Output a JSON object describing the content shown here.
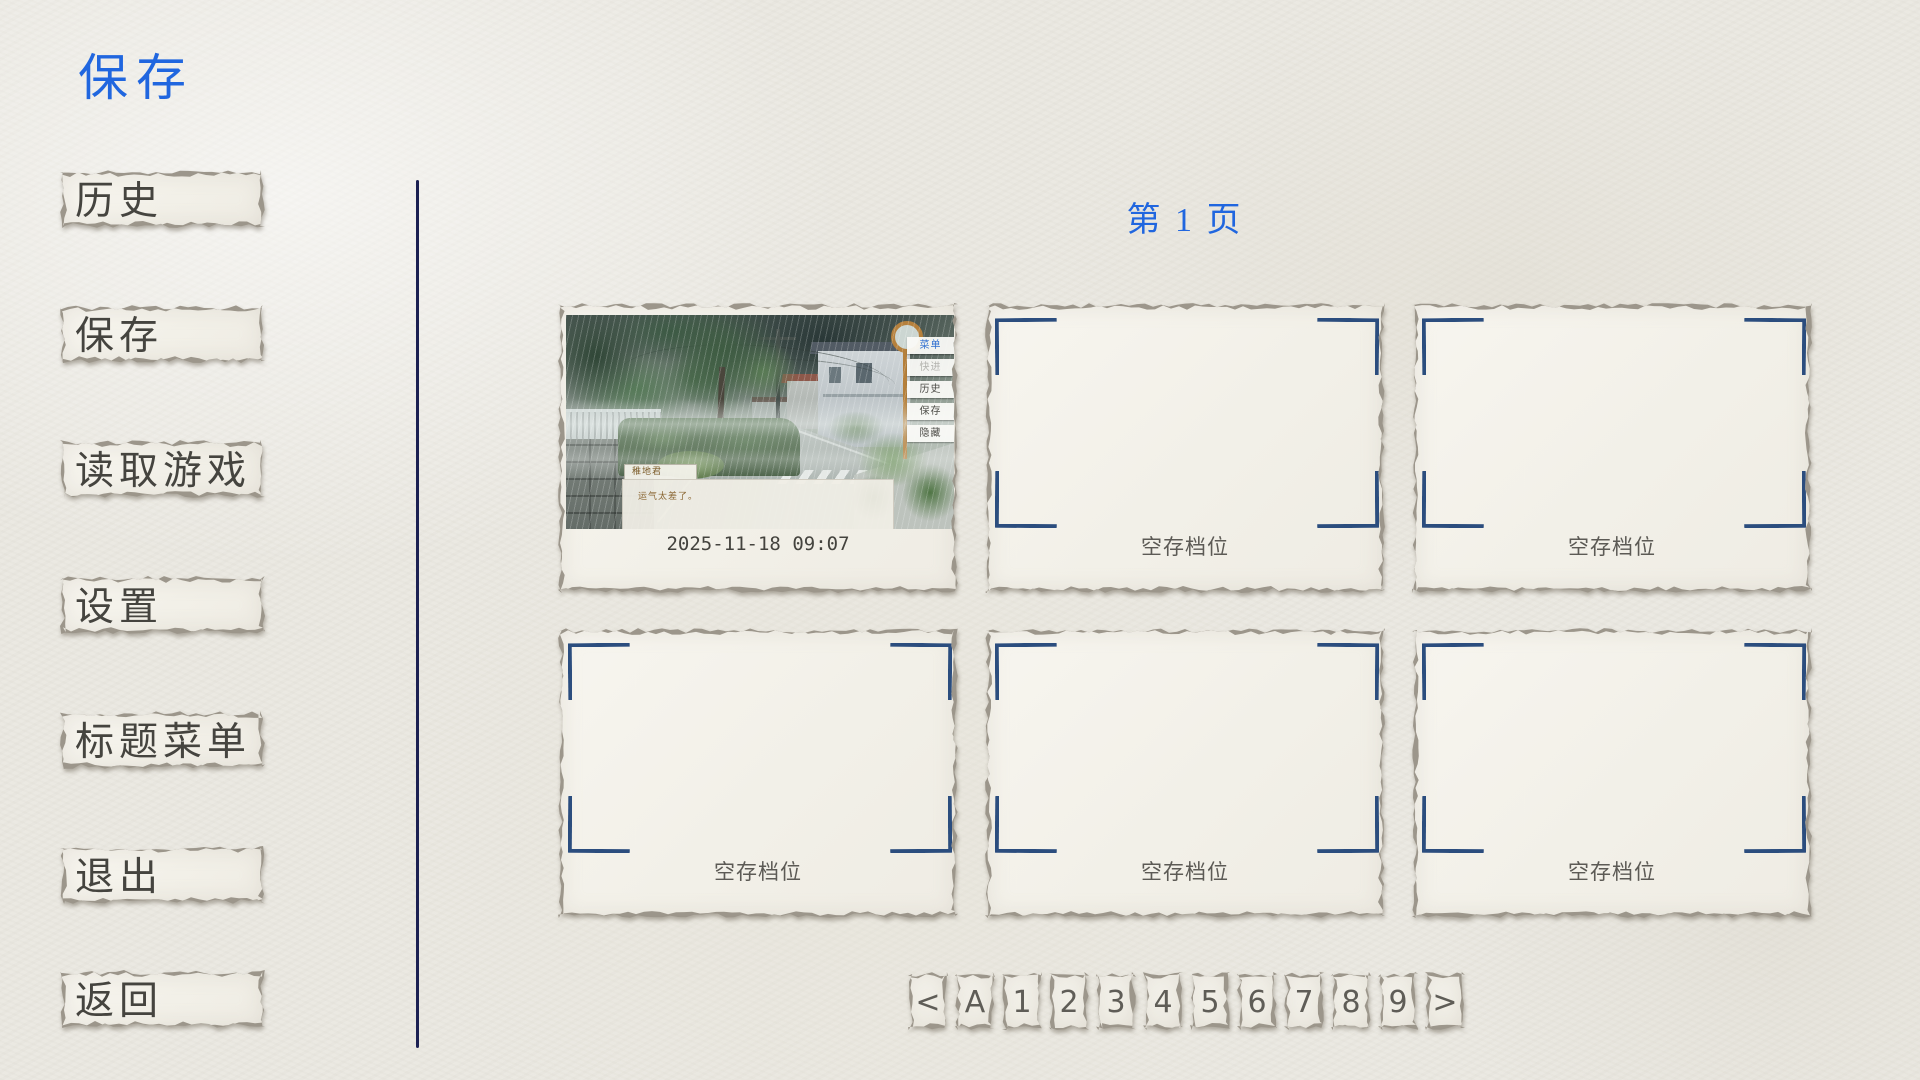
{
  "window": {
    "title": "保存"
  },
  "sidebar": {
    "items": [
      {
        "label": "历史"
      },
      {
        "label": "保存"
      },
      {
        "label": "读取游戏"
      },
      {
        "label": "设置"
      },
      {
        "label": "标题菜单"
      },
      {
        "label": "退出"
      },
      {
        "label": "返回"
      }
    ]
  },
  "main": {
    "page_label": "第 1 页",
    "slots": [
      {
        "state": "filled",
        "label": "2025-11-18 09:07"
      },
      {
        "state": "empty",
        "label": "空存档位"
      },
      {
        "state": "empty",
        "label": "空存档位"
      },
      {
        "state": "empty",
        "label": "空存档位"
      },
      {
        "state": "empty",
        "label": "空存档位"
      },
      {
        "state": "empty",
        "label": "空存档位"
      }
    ],
    "thumbnail": {
      "speaker_name": "稚地君",
      "dialogue_text": "运气太差了。",
      "quick_menu": [
        {
          "label": "菜单",
          "state": "active"
        },
        {
          "label": "快进",
          "state": "disabled"
        },
        {
          "label": "历史",
          "state": "normal"
        },
        {
          "label": "保存",
          "state": "normal"
        },
        {
          "label": "隐藏",
          "state": "normal"
        }
      ]
    }
  },
  "pagination": {
    "buttons": [
      {
        "label": "<"
      },
      {
        "label": "A"
      },
      {
        "label": "1"
      },
      {
        "label": "2"
      },
      {
        "label": "3"
      },
      {
        "label": "4"
      },
      {
        "label": "5"
      },
      {
        "label": "6"
      },
      {
        "label": "7"
      },
      {
        "label": "8"
      },
      {
        "label": "9"
      },
      {
        "label": ">"
      }
    ]
  },
  "colors": {
    "accent_blue": "#2066df",
    "bracket_navy": "#2b4d7e",
    "divider_navy": "#1b2052",
    "paper": "#f4f2eb",
    "button_text_gray": "#45443f"
  }
}
